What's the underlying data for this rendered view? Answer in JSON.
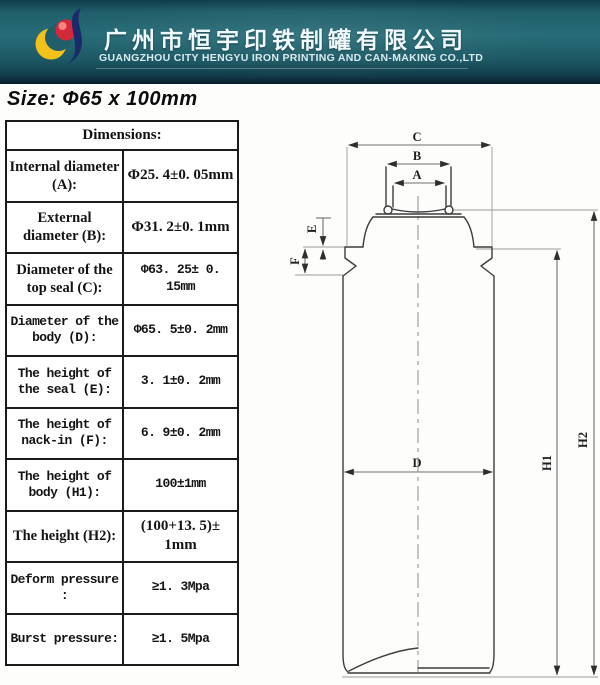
{
  "header": {
    "company_cn": "广州市恒宇印铁制罐有限公司",
    "company_en": "GUANGZHOU CITY HENGYU IRON PRINTING AND CAN-MAKING CO.,LTD"
  },
  "size_title": "Size: Φ65 x 100mm",
  "table": {
    "title": "Dimensions:",
    "rows": [
      {
        "label": "Internal diameter (A):",
        "value": "Φ25. 4±0. 05mm",
        "label_font": "serif",
        "value_font": "serif"
      },
      {
        "label": "External diameter (B):",
        "value": "Φ31. 2±0. 1mm",
        "label_font": "serif",
        "value_font": "serif"
      },
      {
        "label": "Diameter of the top seal (C):",
        "value": "Φ63. 25± 0. 15mm",
        "label_font": "serif",
        "value_font": "mono"
      },
      {
        "label": "Diameter of the body (D):",
        "value": "Φ65. 5±0. 2mm",
        "label_font": "mono",
        "value_font": "mono"
      },
      {
        "label": "The height of the seal (E):",
        "value": "3. 1±0. 2mm",
        "label_font": "mono",
        "value_font": "mono"
      },
      {
        "label": "The height of nack-in (F):",
        "value": "6. 9±0. 2mm",
        "label_font": "mono",
        "value_font": "mono"
      },
      {
        "label": "The height of body (H1):",
        "value": "100±1mm",
        "label_font": "mono",
        "value_font": "mono"
      },
      {
        "label": "The height (H2):",
        "value": "(100+13. 5)± 1mm",
        "label_font": "serif",
        "value_font": "serif"
      },
      {
        "label": "Deform pressure :",
        "value": "≥1. 3Mpa",
        "label_font": "mono",
        "value_font": "mono"
      },
      {
        "label": "Burst pressure:",
        "value": "≥1. 5Mpa",
        "label_font": "mono",
        "value_font": "mono"
      }
    ]
  },
  "drawing": {
    "labels": {
      "a": "A",
      "b": "B",
      "c": "C",
      "d": "D",
      "e": "E",
      "f": "F",
      "h1": "H1",
      "h2": "H2"
    }
  },
  "colors": {
    "header_teal": "#1f5e6a",
    "header_edge_dark": "#081e2b",
    "logo_yellow": "#f2c21a",
    "logo_red": "#d3293a",
    "logo_navy": "#1b2a6b",
    "drawing_line": "#3d3d3d",
    "dimension_line": "#6f6f6f"
  }
}
